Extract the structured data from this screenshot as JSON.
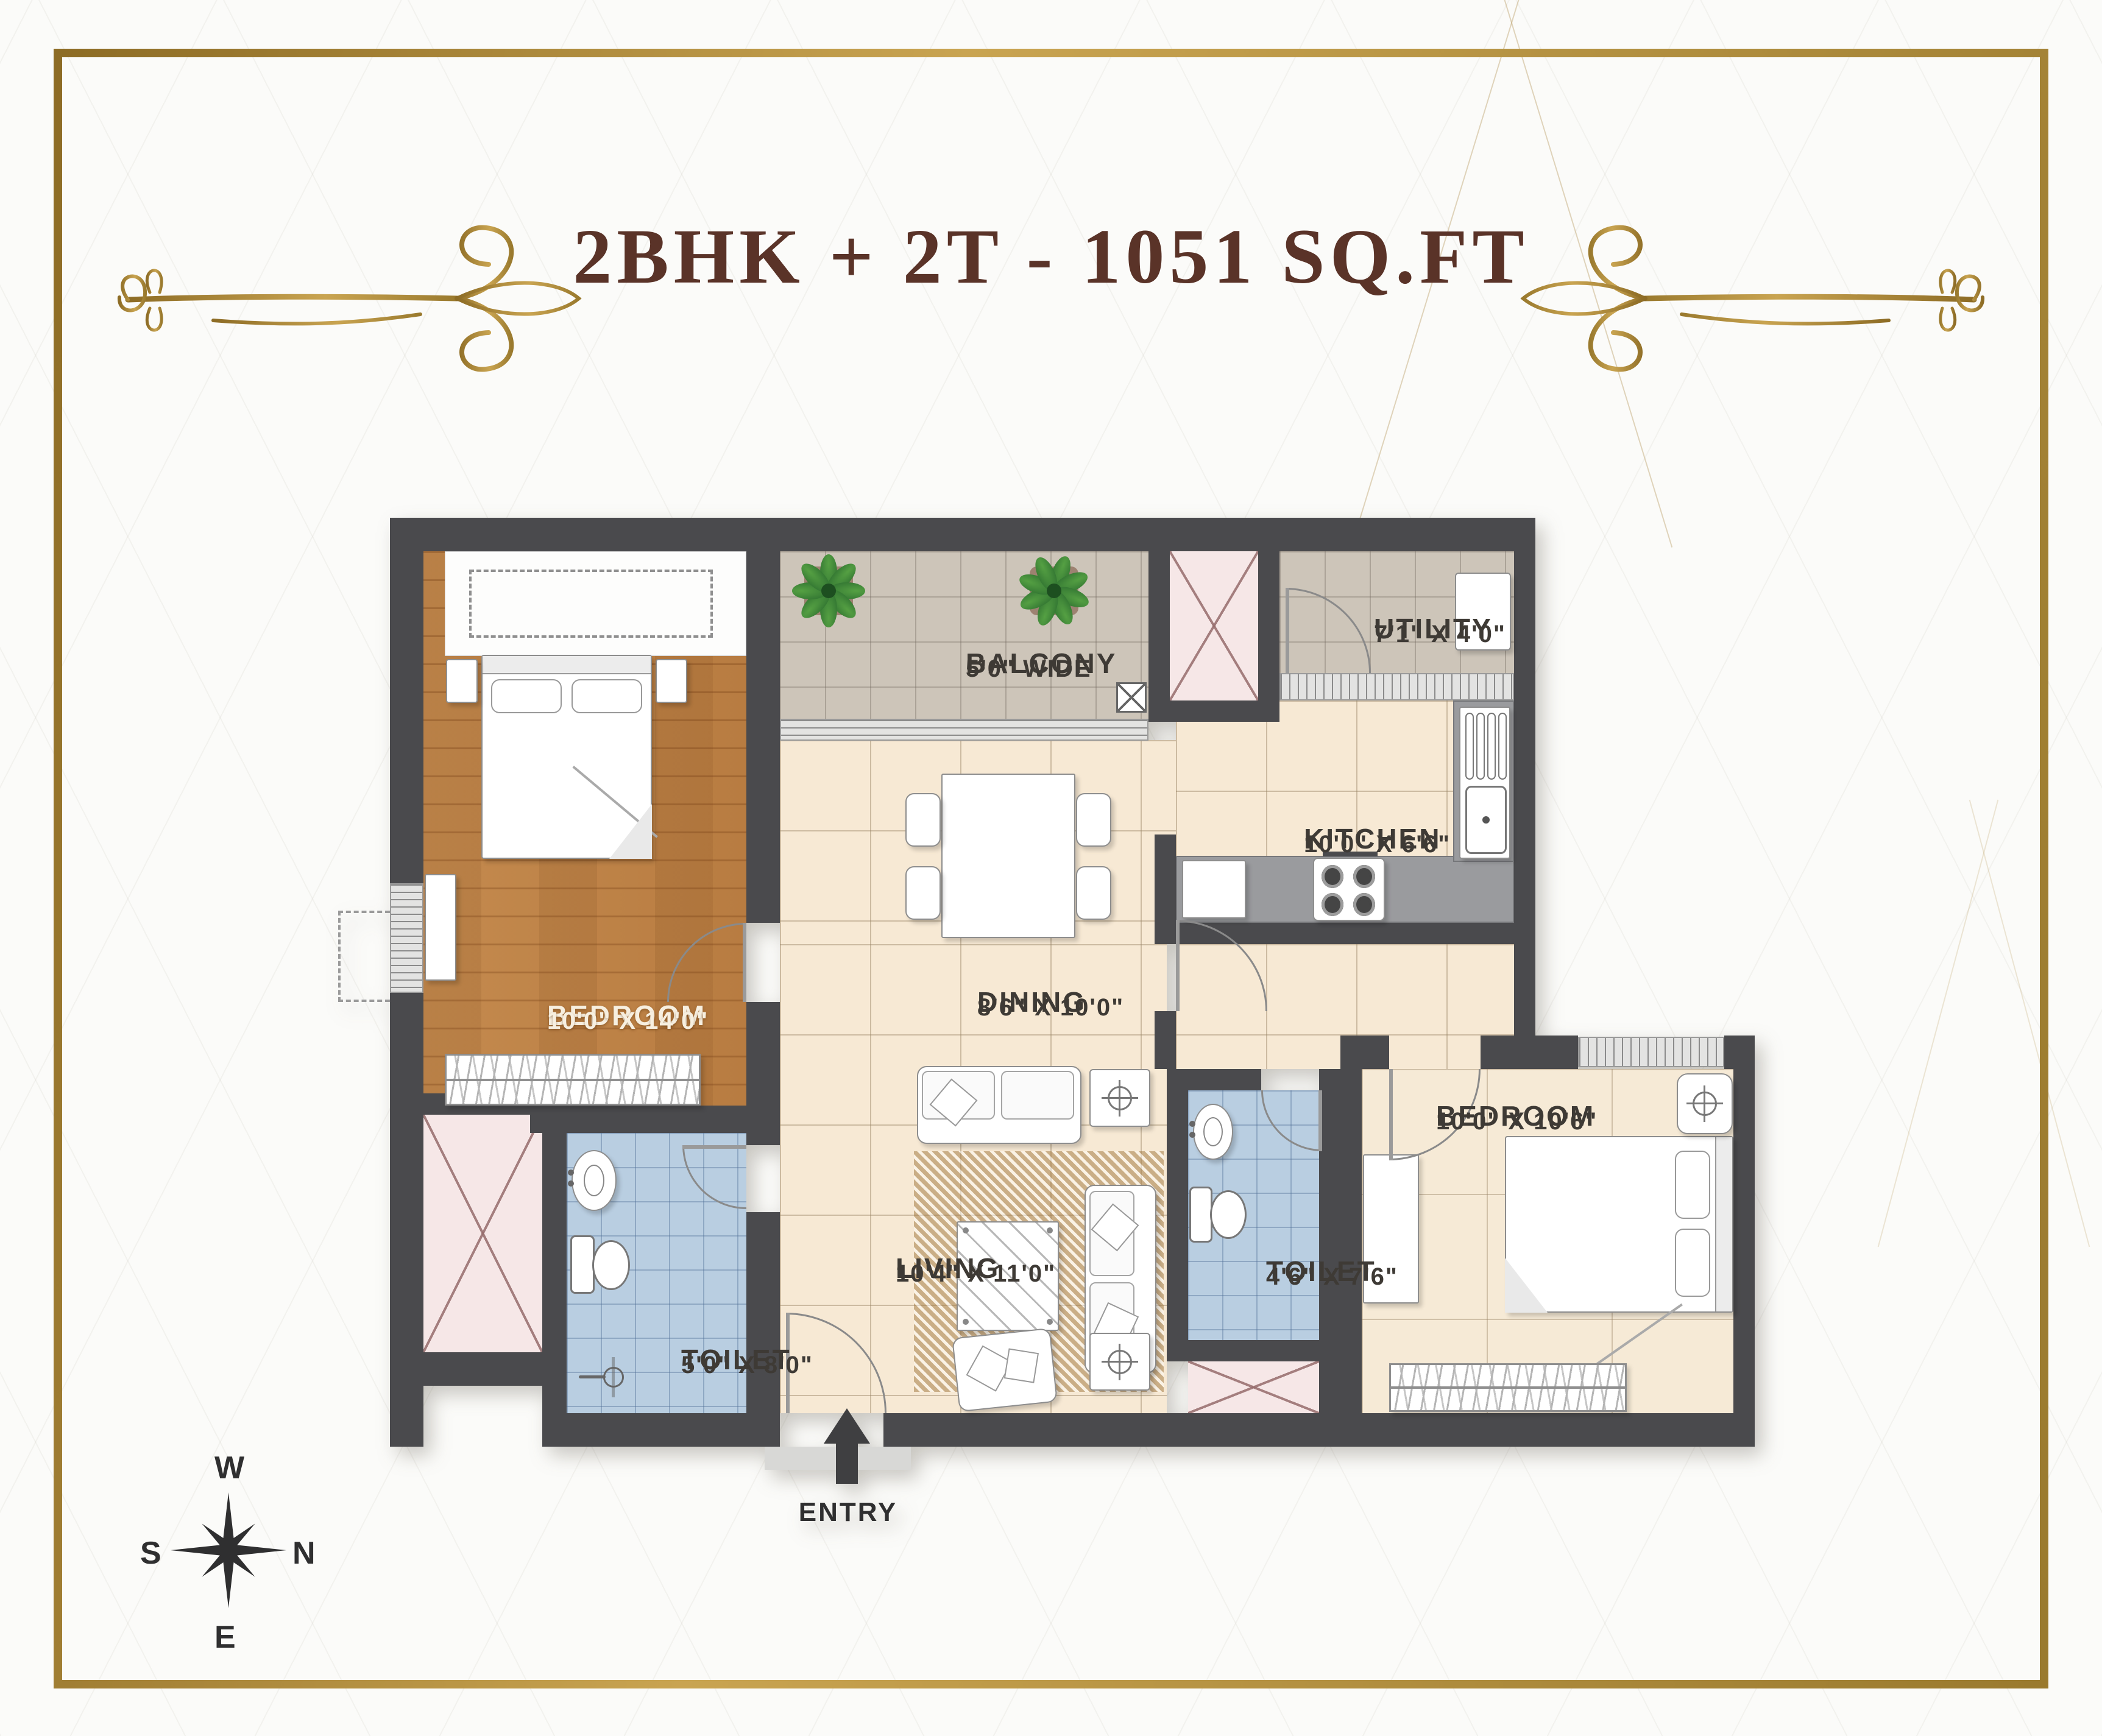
{
  "title": "2BHK + 2T - 1051 SQ.FT",
  "entry": {
    "label": "ENTRY"
  },
  "compass": {
    "top": "W",
    "right": "N",
    "bottom": "E",
    "left": "S"
  },
  "rooms": {
    "balcony": {
      "name": "BALCONY",
      "dims": "5'0\" WIDE"
    },
    "utility": {
      "name": "UTILITY",
      "dims": "7'1\" X 4'0\""
    },
    "kitchen": {
      "name": "KITCHEN",
      "dims": "10'0\" X 6'6\""
    },
    "dining": {
      "name": "DINING",
      "dims": "8'6\" X 10'0\""
    },
    "living": {
      "name": "LIVING",
      "dims": "10'4\" X 11'0\""
    },
    "bedroom1": {
      "name": "BEDROOM",
      "dims": "10'0\" X 14'0\""
    },
    "bedroom2": {
      "name": "BEDROOM",
      "dims": "10'0\" X 10'6\""
    },
    "toilet1": {
      "name": "TOILET",
      "dims": "5'0\" X 8'0\""
    },
    "toilet2": {
      "name": "TOILET",
      "dims": "4'6\" X 7'6\""
    }
  },
  "icons": {
    "plants": "plant-icon",
    "stove": "stove-icon",
    "sink": "sink-icon",
    "wc": "wc-icon",
    "shower": "shower-icon",
    "compass": "compass-rose-icon",
    "entry_arrow": "entry-arrow-icon"
  },
  "colors": {
    "frame_gold": "#a9873b",
    "title_brown": "#5a3328",
    "wall_dark": "#4a4a4d",
    "wood_floor": "#c08246",
    "tile_cream": "#f7e9d4",
    "tile_beige": "#f6ead6",
    "balcony_taupe": "#cdc5b9",
    "toilet_blue": "#b9cee1",
    "duct_pink": "#f6e7e7",
    "counter_gray": "#9a9b9e",
    "compass_dark": "#2f2f30"
  }
}
